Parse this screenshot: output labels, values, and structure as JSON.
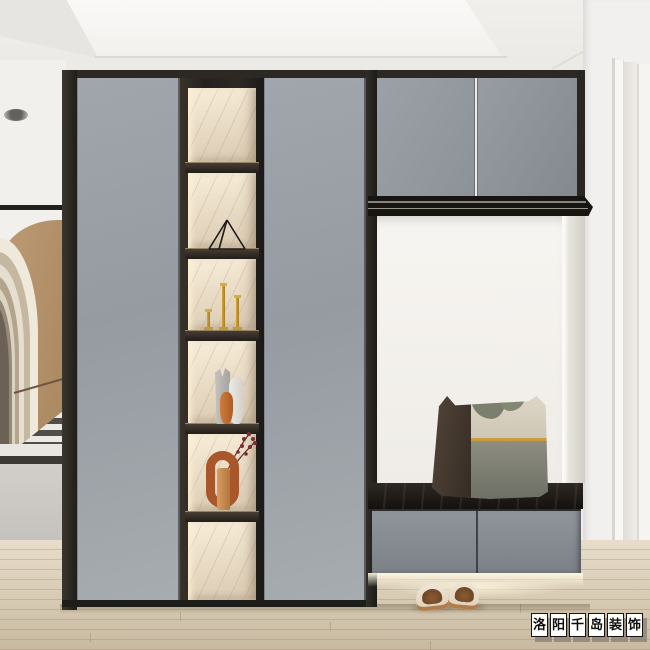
{
  "image": {
    "type": "interior-design-render",
    "room": "entryway-hallway",
    "style": "modern grey hallway cabinet with lit display niche, bench seat and mirror-finish doors"
  },
  "watermark": {
    "text": "洛阳千岛装饰",
    "chars": [
      "洛",
      "阳",
      "千",
      "岛",
      "装",
      "饰"
    ]
  },
  "palette": {
    "cabinet_grey": "#9aa0a6",
    "frame_dark": "#2b2824",
    "marble_backing": "#ecdcc4",
    "accent_gold": "#c59232",
    "bench_top": "#1d1a16",
    "wall_white": "#f2f0ed",
    "floor_wood": "#d9ccb6",
    "arch_brown": "#b08a64",
    "sculpture_orange": "#a8562a",
    "pillow_olive": "#8d8d80",
    "slipper_tan": "#b07c4a"
  },
  "objects": {
    "tall_doors": 2,
    "upper_cabinet_doors": 2,
    "display_cells": 6,
    "shelf_items": [
      "empty",
      "wire-triangle-ornament",
      "gold-candlesticks",
      "vase-trio",
      "arch-sculpture-with-red-flowers",
      "empty"
    ],
    "bench_drawers": 2,
    "pillow": "olive-and-beige cushion with gold stripe and dark side band",
    "slippers": "pair of tan open-back slippers",
    "left_view": "arched corridor with black-and-white staircase"
  }
}
